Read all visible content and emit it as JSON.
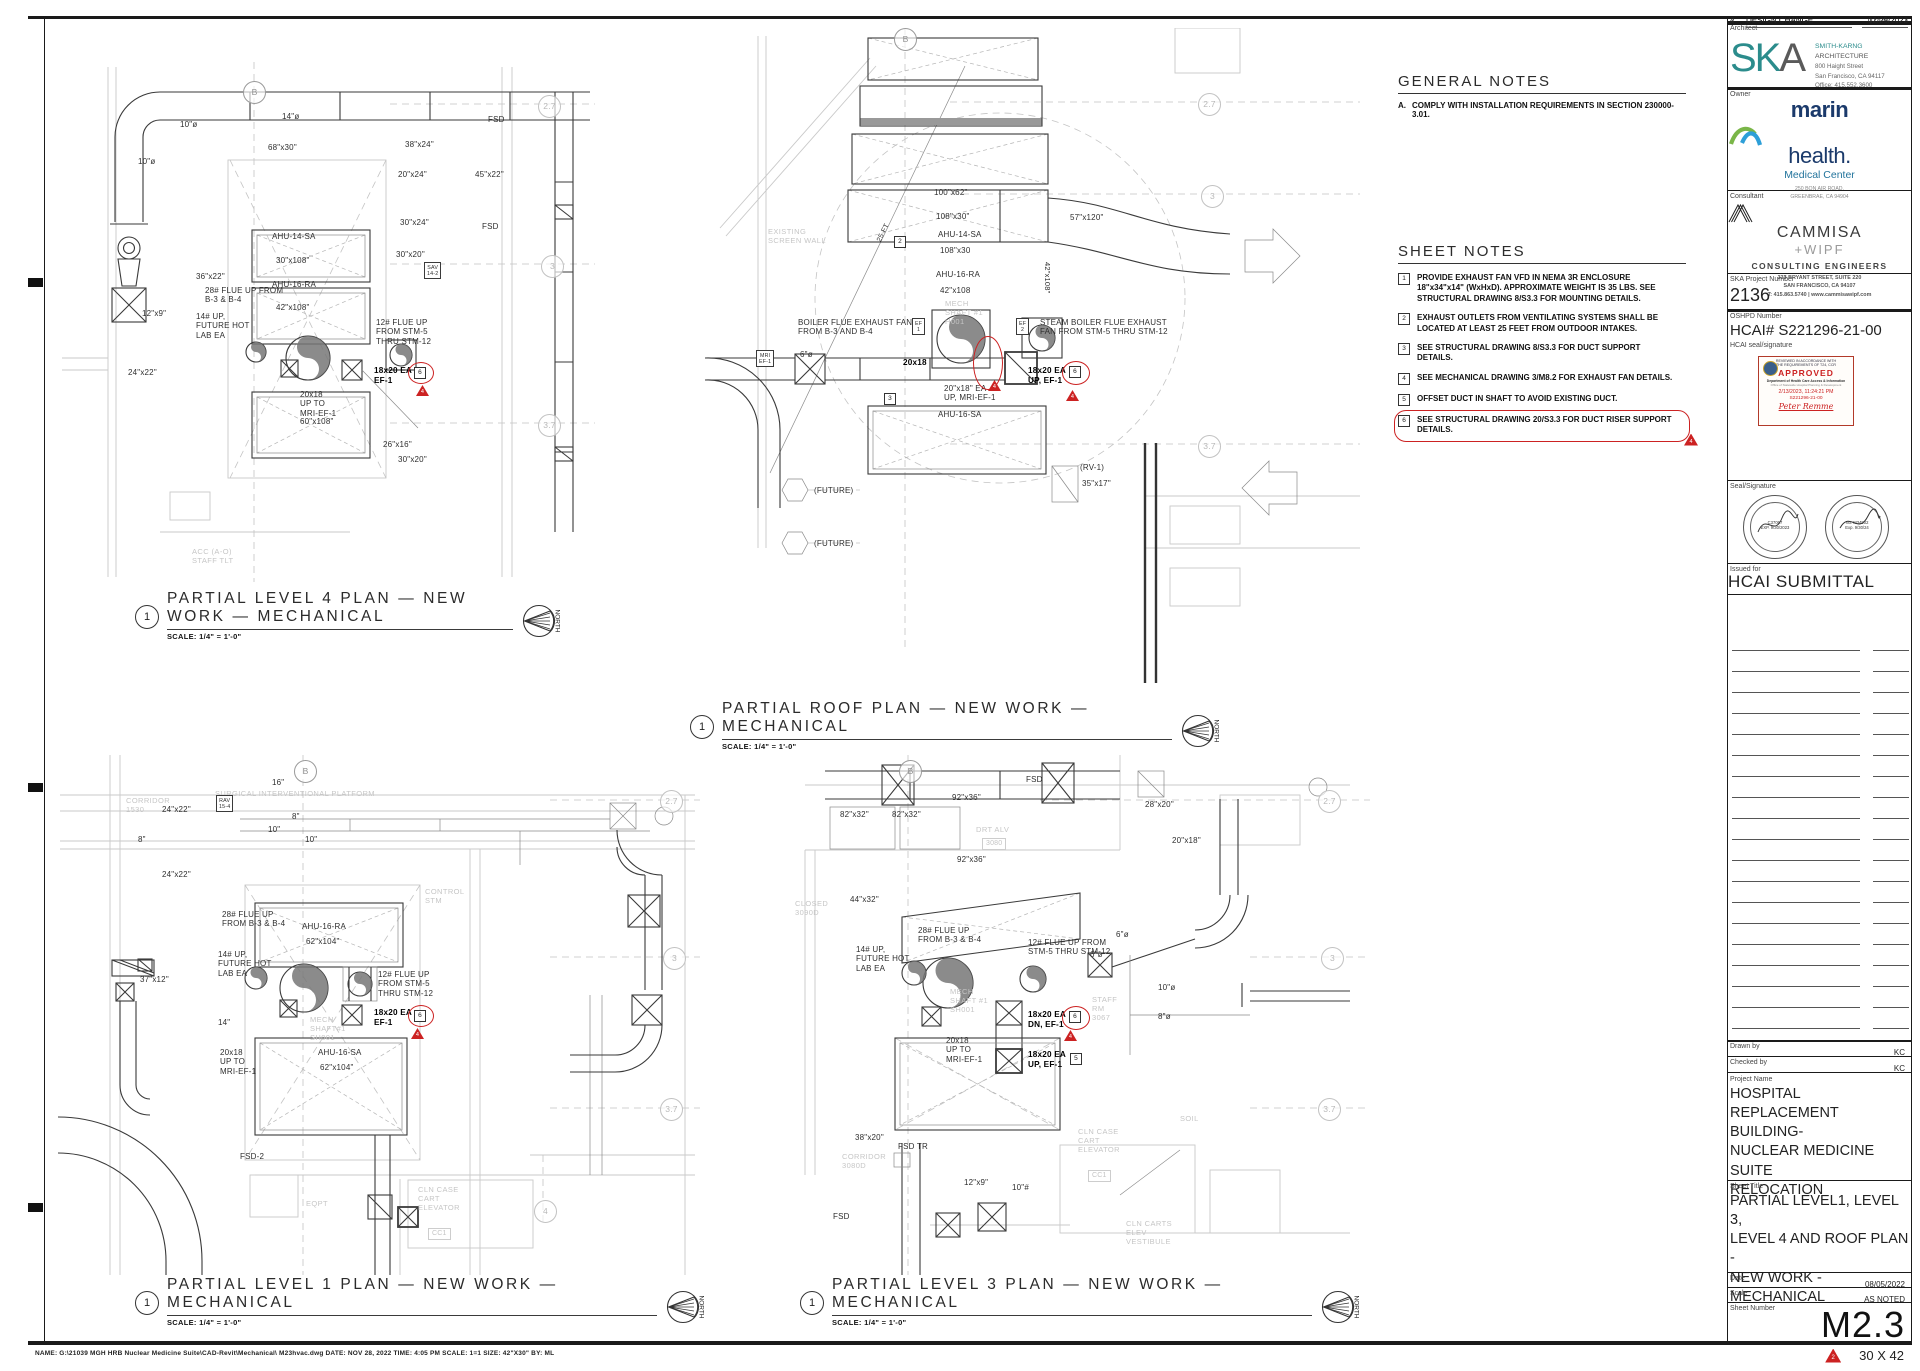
{
  "notes": {
    "general": {
      "title": "GENERAL NOTES",
      "items": [
        {
          "num": "A.",
          "text": "COMPLY WITH INSTALLATION REQUIREMENTS IN SECTION 230000-3.01."
        }
      ]
    },
    "sheet": {
      "title": "SHEET NOTES",
      "items": [
        {
          "num": "1",
          "text": "PROVIDE EXHAUST FAN VFD IN NEMA 3R ENCLOSURE 18\"x34\"x14\" (WxHxD). APPROXIMATE WEIGHT IS 35 LBS. SEE STRUCTURAL DRAWING 8/S3.3 FOR MOUNTING DETAILS."
        },
        {
          "num": "2",
          "text": "EXHAUST OUTLETS FROM VENTILATING SYSTEMS SHALL BE LOCATED AT LEAST 25 FEET FROM OUTDOOR INTAKES."
        },
        {
          "num": "3",
          "text": "SEE STRUCTURAL DRAWING 8/S3.3 FOR DUCT SUPPORT DETAILS."
        },
        {
          "num": "4",
          "text": "SEE MECHANICAL DRAWING 3/M8.2 FOR EXHAUST FAN DETAILS."
        },
        {
          "num": "5",
          "text": "OFFSET DUCT IN SHAFT TO AVOID EXISTING DUCT."
        },
        {
          "num": "6",
          "text": "SEE STRUCTURAL DRAWING 20/S3.3 FOR DUCT RISER SUPPORT DETAILS.",
          "cls": "clouded",
          "tri": "4"
        }
      ]
    }
  },
  "plan_titles": [
    {
      "num": "1",
      "line1": "PARTIAL LEVEL 4 PLAN — NEW",
      "line2": "WORK — MECHANICAL",
      "scale": "SCALE: 1/4\" = 1'-0\"",
      "x": 135,
      "y": 590,
      "w": 378
    },
    {
      "num": "1",
      "line1": "PARTIAL ROOF PLAN — NEW WORK — MECHANICAL",
      "line2": "",
      "scale": "SCALE: 1/4\" = 1'-0\"",
      "x": 690,
      "y": 700,
      "w": 482
    },
    {
      "num": "1",
      "line1": "PARTIAL LEVEL 1 PLAN — NEW WORK — MECHANICAL",
      "line2": "",
      "scale": "SCALE: 1/4\" = 1'-0\"",
      "x": 135,
      "y": 1276,
      "w": 522
    },
    {
      "num": "1",
      "line1": "PARTIAL LEVEL 3 PLAN — NEW WORK — MECHANICAL",
      "line2": "",
      "scale": "SCALE: 1/4\" = 1'-0\"",
      "x": 800,
      "y": 1276,
      "w": 512
    }
  ],
  "annotations": [
    {
      "t": "B",
      "x": 243,
      "y": 81,
      "cls": "bub bubB"
    },
    {
      "t": "10\"ø",
      "x": 180,
      "y": 120
    },
    {
      "t": "14\"ø",
      "x": 282,
      "y": 112
    },
    {
      "t": "10\"ø",
      "x": 138,
      "y": 157
    },
    {
      "t": "68\"x30\"",
      "x": 268,
      "y": 143
    },
    {
      "t": "38\"x24\"",
      "x": 405,
      "y": 140
    },
    {
      "t": "FSD",
      "x": 488,
      "y": 115
    },
    {
      "t": "20\"x24\"",
      "x": 398,
      "y": 170
    },
    {
      "t": "45\"x22\"",
      "x": 475,
      "y": 170
    },
    {
      "t": "FSD",
      "x": 482,
      "y": 222
    },
    {
      "t": "30\"x24\"",
      "x": 400,
      "y": 218
    },
    {
      "t": "AHU-14-SA",
      "x": 272,
      "y": 232
    },
    {
      "t": "30\"x108\"",
      "x": 276,
      "y": 256
    },
    {
      "t": "AHU-16-RA",
      "x": 272,
      "y": 280
    },
    {
      "t": "42\"x108\"",
      "x": 276,
      "y": 303
    },
    {
      "t": "30\"x20\"",
      "x": 396,
      "y": 250
    },
    {
      "t": "SAV\n14-2",
      "x": 424,
      "y": 262,
      "cls": "hex"
    },
    {
      "t": "36\"x22\"",
      "x": 196,
      "y": 272
    },
    {
      "t": "12\"x9\"",
      "x": 142,
      "y": 309
    },
    {
      "t": "28# FLUE UP FROM\nB-3 & B-4",
      "x": 205,
      "y": 286
    },
    {
      "t": "14# UP,\nFUTURE HOT\nLAB EA",
      "x": 196,
      "y": 312
    },
    {
      "t": "12# FLUE UP\nFROM STM-5\nTHRU STM-12",
      "x": 376,
      "y": 318
    },
    {
      "t": "18x20 EA\nEF-1",
      "x": 374,
      "y": 366,
      "cls": "b"
    },
    {
      "t": "",
      "x": 408,
      "y": 362,
      "cls": "oval",
      "w": 24,
      "h": 20
    },
    {
      "t": "6",
      "x": 414,
      "y": 367,
      "cls": "nbox"
    },
    {
      "t": "4",
      "x": 416,
      "y": 385,
      "cls": "tri"
    },
    {
      "t": "20x18\nUP TO\nMRI-EF-1",
      "x": 300,
      "y": 390
    },
    {
      "t": "60\"x108\"",
      "x": 300,
      "y": 417
    },
    {
      "t": "26\"x16\"",
      "x": 383,
      "y": 440
    },
    {
      "t": "30\"x20\"",
      "x": 398,
      "y": 455
    },
    {
      "t": "24\"x22\"",
      "x": 128,
      "y": 368
    },
    {
      "t": "ACC (A-O)\nSTAFF TLT",
      "x": 192,
      "y": 548,
      "cls": "g"
    },
    {
      "t": "2.7",
      "x": 538,
      "y": 95,
      "cls": "bub"
    },
    {
      "t": "3",
      "x": 541,
      "y": 255,
      "cls": "bub"
    },
    {
      "t": "3.7",
      "x": 538,
      "y": 414,
      "cls": "bub"
    },
    {
      "t": "B",
      "x": 894,
      "y": 28,
      "cls": "bub bubB"
    },
    {
      "t": "2.7",
      "x": 1198,
      "y": 93,
      "cls": "bub"
    },
    {
      "t": "3",
      "x": 1201,
      "y": 185,
      "cls": "bub"
    },
    {
      "t": "3.7",
      "x": 1198,
      "y": 435,
      "cls": "bub"
    },
    {
      "t": "EXISTING\nSCREEN WALL",
      "x": 768,
      "y": 228,
      "cls": "g"
    },
    {
      "t": "25 FT",
      "x": 876,
      "y": 240,
      "cls": "rot"
    },
    {
      "t": "2",
      "x": 894,
      "y": 236,
      "cls": "nbox"
    },
    {
      "t": "100\"x62\"",
      "x": 934,
      "y": 188
    },
    {
      "t": "108\"x30\"",
      "x": 936,
      "y": 212
    },
    {
      "t": "AHU-14-SA",
      "x": 938,
      "y": 230
    },
    {
      "t": "108\"x30",
      "x": 940,
      "y": 246
    },
    {
      "t": "AHU-16-RA",
      "x": 936,
      "y": 270
    },
    {
      "t": "42\"x108",
      "x": 940,
      "y": 286
    },
    {
      "t": "42\"x108\"",
      "x": 1042,
      "y": 262,
      "cls": "vert"
    },
    {
      "t": "57\"x120\"",
      "x": 1070,
      "y": 213
    },
    {
      "t": "BOILER FLUE EXHAUST FAN\nFROM B-3 AND B-4",
      "x": 798,
      "y": 318
    },
    {
      "t": "EF\n1",
      "x": 912,
      "y": 318,
      "cls": "hex"
    },
    {
      "t": "STEAM BOILER FLUE EXHAUST\nFAN FROM STM-5 THRU STM-12",
      "x": 1040,
      "y": 318
    },
    {
      "t": "EF\n2",
      "x": 1016,
      "y": 318,
      "cls": "hex"
    },
    {
      "t": "MECH\nSHAFT #1\nH001",
      "x": 945,
      "y": 300,
      "cls": "g"
    },
    {
      "t": "MRI\nEF-1",
      "x": 756,
      "y": 350,
      "cls": "hex"
    },
    {
      "t": "6\"ø",
      "x": 800,
      "y": 350
    },
    {
      "t": "20x18",
      "x": 903,
      "y": 358,
      "cls": "b"
    },
    {
      "t": "",
      "x": 973,
      "y": 336,
      "cls": "oval",
      "w": 28,
      "h": 52
    },
    {
      "t": "4",
      "x": 988,
      "y": 380,
      "cls": "tri"
    },
    {
      "t": "18x20 EA\nUP, EF-1",
      "x": 1028,
      "y": 366,
      "cls": "b"
    },
    {
      "t": "",
      "x": 1062,
      "y": 361,
      "cls": "oval",
      "w": 26,
      "h": 22
    },
    {
      "t": "6",
      "x": 1069,
      "y": 366,
      "cls": "nbox"
    },
    {
      "t": "4",
      "x": 1066,
      "y": 390,
      "cls": "tri"
    },
    {
      "t": "3",
      "x": 884,
      "y": 393,
      "cls": "nbox"
    },
    {
      "t": "20\"x18\" EA\nUP, MRI-EF-1",
      "x": 944,
      "y": 384
    },
    {
      "t": "AHU-16-SA",
      "x": 938,
      "y": 410
    },
    {
      "t": "(FUTURE)",
      "x": 814,
      "y": 486
    },
    {
      "t": "(FUTURE)",
      "x": 814,
      "y": 539
    },
    {
      "t": "(RV-1)",
      "x": 1080,
      "y": 463
    },
    {
      "t": "35\"x17\"",
      "x": 1082,
      "y": 479
    },
    {
      "t": "B",
      "x": 294,
      "y": 760,
      "cls": "bub bubB"
    },
    {
      "t": "2.7",
      "x": 660,
      "y": 790,
      "cls": "bub"
    },
    {
      "t": "3",
      "x": 663,
      "y": 947,
      "cls": "bub"
    },
    {
      "t": "3.7",
      "x": 660,
      "y": 1098,
      "cls": "bub"
    },
    {
      "t": "4",
      "x": 534,
      "y": 1200,
      "cls": "bub"
    },
    {
      "t": "SURGICAL INTERVENTIONAL PLATFORM",
      "x": 215,
      "y": 790,
      "cls": "g"
    },
    {
      "t": "CORRIDOR\n1530",
      "x": 126,
      "y": 797,
      "cls": "g"
    },
    {
      "t": "16\"",
      "x": 272,
      "y": 778
    },
    {
      "t": "24\"x22\"",
      "x": 162,
      "y": 805
    },
    {
      "t": "RAV\n15-4",
      "x": 216,
      "y": 795,
      "cls": "hex"
    },
    {
      "t": "8\"",
      "x": 292,
      "y": 812
    },
    {
      "t": "10\"",
      "x": 268,
      "y": 825
    },
    {
      "t": "8\"",
      "x": 138,
      "y": 835
    },
    {
      "t": "10\"",
      "x": 305,
      "y": 835
    },
    {
      "t": "24\"x22\"",
      "x": 162,
      "y": 870
    },
    {
      "t": "28# FLUE UP\nFROM B-3 & B-4",
      "x": 222,
      "y": 910
    },
    {
      "t": "AHU-16-RA",
      "x": 302,
      "y": 922
    },
    {
      "t": "62\"x104\"",
      "x": 306,
      "y": 937
    },
    {
      "t": "14# UP,\nFUTURE HOT\nLAB EA",
      "x": 218,
      "y": 950
    },
    {
      "t": "12# FLUE UP\nFROM STM-5\nTHRU STM-12",
      "x": 378,
      "y": 970
    },
    {
      "t": "18x20 EA\nEF-1",
      "x": 374,
      "y": 1008,
      "cls": "b"
    },
    {
      "t": "",
      "x": 408,
      "y": 1005,
      "cls": "oval",
      "w": 24,
      "h": 20
    },
    {
      "t": "6",
      "x": 414,
      "y": 1010,
      "cls": "nbox"
    },
    {
      "t": "4",
      "x": 411,
      "y": 1028,
      "cls": "tri"
    },
    {
      "t": "20x18\nUP TO\nMRI-EF-1",
      "x": 220,
      "y": 1048
    },
    {
      "t": "AHU-16-SA",
      "x": 318,
      "y": 1048
    },
    {
      "t": "62\"x104\"",
      "x": 320,
      "y": 1063
    },
    {
      "t": "MECH\nSHAFT#1\nSH001",
      "x": 310,
      "y": 1016,
      "cls": "g"
    },
    {
      "t": "CONTROL\nSTM",
      "x": 425,
      "y": 888,
      "cls": "g"
    },
    {
      "t": "37\"x12\"",
      "x": 140,
      "y": 975
    },
    {
      "t": "14\"",
      "x": 218,
      "y": 1018
    },
    {
      "t": "FSD-2",
      "x": 240,
      "y": 1152
    },
    {
      "t": "EQPT",
      "x": 306,
      "y": 1200,
      "cls": "g"
    },
    {
      "t": "CLN CASE\nCART\nELEVATOR",
      "x": 418,
      "y": 1186,
      "cls": "g"
    },
    {
      "t": "CC1",
      "x": 428,
      "y": 1228,
      "cls": "gbox"
    },
    {
      "t": "B",
      "x": 899,
      "y": 760,
      "cls": "bub bubB"
    },
    {
      "t": "2.7",
      "x": 1318,
      "y": 790,
      "cls": "bub"
    },
    {
      "t": "3",
      "x": 1321,
      "y": 947,
      "cls": "bub"
    },
    {
      "t": "3.7",
      "x": 1318,
      "y": 1098,
      "cls": "bub"
    },
    {
      "t": "FSD",
      "x": 1026,
      "y": 775
    },
    {
      "t": "92\"x36\"",
      "x": 952,
      "y": 793
    },
    {
      "t": "28\"x20\"",
      "x": 1145,
      "y": 800
    },
    {
      "t": "82\"x32\"",
      "x": 840,
      "y": 810
    },
    {
      "t": "82\"x32\"",
      "x": 892,
      "y": 810
    },
    {
      "t": "20\"x18\"",
      "x": 1172,
      "y": 836
    },
    {
      "t": "DRT ALV",
      "x": 976,
      "y": 826,
      "cls": "g"
    },
    {
      "t": "3080",
      "x": 982,
      "y": 838,
      "cls": "gbox"
    },
    {
      "t": "92\"x36\"",
      "x": 957,
      "y": 855
    },
    {
      "t": "44\"x32\"",
      "x": 850,
      "y": 895
    },
    {
      "t": "CLOSED\n3090D",
      "x": 795,
      "y": 900,
      "cls": "g"
    },
    {
      "t": "28# FLUE UP\nFROM B-3 & B-4",
      "x": 918,
      "y": 926
    },
    {
      "t": "12# FLUE UP FROM\nSTM-5 THRU STM-12",
      "x": 1028,
      "y": 938
    },
    {
      "t": "14# UP,\nFUTURE HOT\nLAB EA",
      "x": 856,
      "y": 945
    },
    {
      "t": "MECH\nSHAFT #1\nSH001",
      "x": 950,
      "y": 988,
      "cls": "g"
    },
    {
      "t": "18x20 EA\nDN, EF-1",
      "x": 1028,
      "y": 1010,
      "cls": "b"
    },
    {
      "t": "",
      "x": 1062,
      "y": 1006,
      "cls": "oval",
      "w": 26,
      "h": 22
    },
    {
      "t": "6",
      "x": 1069,
      "y": 1011,
      "cls": "nbox"
    },
    {
      "t": "4",
      "x": 1064,
      "y": 1030,
      "cls": "tri"
    },
    {
      "t": "18x20 EA\nUP, EF-1",
      "x": 1028,
      "y": 1050,
      "cls": "b"
    },
    {
      "t": "5",
      "x": 1070,
      "y": 1053,
      "cls": "nbox"
    },
    {
      "t": "20x18\nUP TO\nMRI-EF-1",
      "x": 946,
      "y": 1036
    },
    {
      "t": "6\"ø",
      "x": 1090,
      "y": 950
    },
    {
      "t": "6\"ø",
      "x": 1116,
      "y": 930
    },
    {
      "t": "10\"ø",
      "x": 1158,
      "y": 983
    },
    {
      "t": "8\"ø",
      "x": 1158,
      "y": 1012
    },
    {
      "t": "STAFF\nRM\n3067",
      "x": 1092,
      "y": 996,
      "cls": "g"
    },
    {
      "t": "38\"x20\"",
      "x": 855,
      "y": 1133
    },
    {
      "t": "CORRIDOR\n3080D",
      "x": 842,
      "y": 1153,
      "cls": "g"
    },
    {
      "t": "FSD TR",
      "x": 898,
      "y": 1142
    },
    {
      "t": "12\"x9\"",
      "x": 964,
      "y": 1178
    },
    {
      "t": "10\"#",
      "x": 1012,
      "y": 1183
    },
    {
      "t": "FSD",
      "x": 833,
      "y": 1212
    },
    {
      "t": "SOIL",
      "x": 1180,
      "y": 1115,
      "cls": "g"
    },
    {
      "t": "CLN CASE\nCART\nELEVATOR",
      "x": 1078,
      "y": 1128,
      "cls": "g"
    },
    {
      "t": "CC1",
      "x": 1088,
      "y": 1170,
      "cls": "gbox"
    },
    {
      "t": "CLN CARTS\nELEV\nVESTIBULE",
      "x": 1126,
      "y": 1220,
      "cls": "g"
    }
  ],
  "titleblock": {
    "architect_label": "Architect",
    "ska": {
      "sk": "SK",
      "a": "A",
      "firm": "SMITH-KARNG",
      "firm2": " ARCHITECTURE",
      "addr1": "800 Haight Street",
      "addr2": "San Francisco, CA 94117",
      "addr3": "Office:        415.552.3600"
    },
    "owner_label": "Owner",
    "owner": {
      "n1": "marin",
      "n2": "health.",
      "mc": "Medical Center",
      "addr1": "250 BON AIR ROAD,",
      "addr2": "GREENBRAE, CA 94904"
    },
    "consultant_label": "Consultant",
    "consultant": {
      "name": "CAMMISA",
      "wipf": "+WIPF",
      "tag": "CONSULTING ENGINEERS",
      "addr1": "333 BRYANT STREET, SUITE 220",
      "addr2": "SAN FRANCISCO, CA 94107",
      "addr3": "T: 415.863.5740 | www.cammisawipf.com"
    },
    "ska_project_label": "SKA Project Number",
    "ska_project": "2136",
    "oshpd_label": "OSHPD Number",
    "oshpd": "HCAI# S221296-21-00",
    "hcai_seal_label": "HCAI seal/signature",
    "stamp": {
      "l1": "REVIEWED IN ACCORDANCE WITH",
      "l2": "THE REQUIREMENTS OF T24, CCR",
      "approved": "APPROVED",
      "dept": "Department of Health Care Access & Information",
      "office": "Office of Statewide Hospital Planning & Development",
      "date": "2/13/2023, 11:24:21 PM",
      "num": "S221296-21-00",
      "name": "Peter Remme"
    },
    "seal_label": "Seal/Signature",
    "seal1": {
      "no": "C37067",
      "exp": "EXP. 9/30/2023"
    },
    "seal2": {
      "no": "No. M34902",
      "exp": "Exp. 9/30/24"
    },
    "issued_label": "Issued for",
    "issued": "HCAI SUBMITTAL",
    "revisions": [
      {
        "no": "2",
        "desc": "DESIGN CHANGE",
        "date": "12/09/2022"
      },
      {
        "no": "4",
        "desc": "DESIGN CHANGE",
        "date": "01/25/2023"
      }
    ],
    "drawn_label": "Drawn by",
    "drawn": "KC",
    "checked_label": "Checked by",
    "checked": "KC",
    "project_label": "Project Name",
    "project": "HOSPITAL REPLACEMENT\nBUILDING-\nNUCLEAR MEDICINE SUITE\nRELOCATION",
    "sheet_title_label": "Sheet Title",
    "sheet_title": "PARTIAL LEVEL1, LEVEL 3,\nLEVEL 4 AND ROOF PLAN -\nNEW WORK - MECHANICAL",
    "date_label": "Date",
    "date": "08/05/2022",
    "scale_label": "Scale",
    "scale": "AS NOTED",
    "sheet_number_label": "Sheet Number",
    "sheet_number": "M2.3",
    "badge_rev": "2",
    "badge_size": "30 X 42"
  },
  "footer": {
    "text": "NAME: G:\\21039 MGH HRB Nuclear Medicine Suite\\CAD-Revit\\Mechanical\\ M23hvac.dwg   DATE: NOV 28, 2022   TIME: 4:05 PM   SCALE: 1=1   SIZE: 42\"X30\"   BY: ML"
  }
}
